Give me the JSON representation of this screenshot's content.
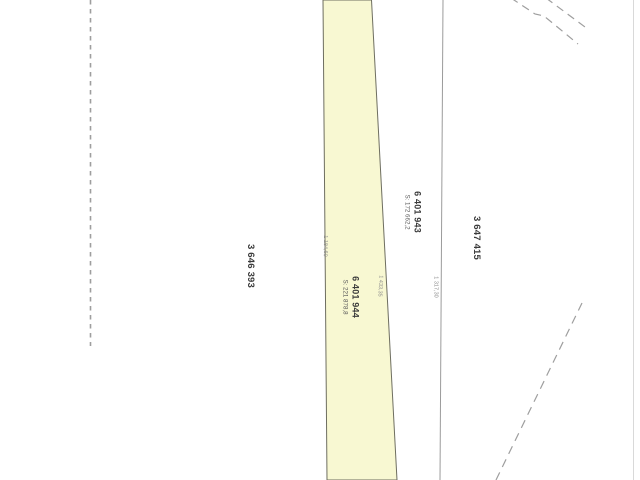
{
  "document": {
    "type": "cadastral-plan-scan",
    "background": "#ffffff"
  },
  "colors": {
    "parcel_fill": "#f8f8d2",
    "parcel_outline": "#6e6e60",
    "boundary_line": "#9b9b9b",
    "dashed_line": "#9e9e9e",
    "scan_edge": "#d9d9d9"
  },
  "lots": {
    "left": {
      "number": "3 646 393"
    },
    "highlighted": {
      "number": "6 401 944",
      "area": "S: 221 878,8"
    },
    "sliver": {
      "number": "6 401 943",
      "area": "S: 172 662,2"
    },
    "right": {
      "number": "3 647 415"
    }
  },
  "dimensions": {
    "strip_left_edge": "1 184,60",
    "strip_right_edge": "1 433,35",
    "east_boundary": "1 317,30"
  }
}
